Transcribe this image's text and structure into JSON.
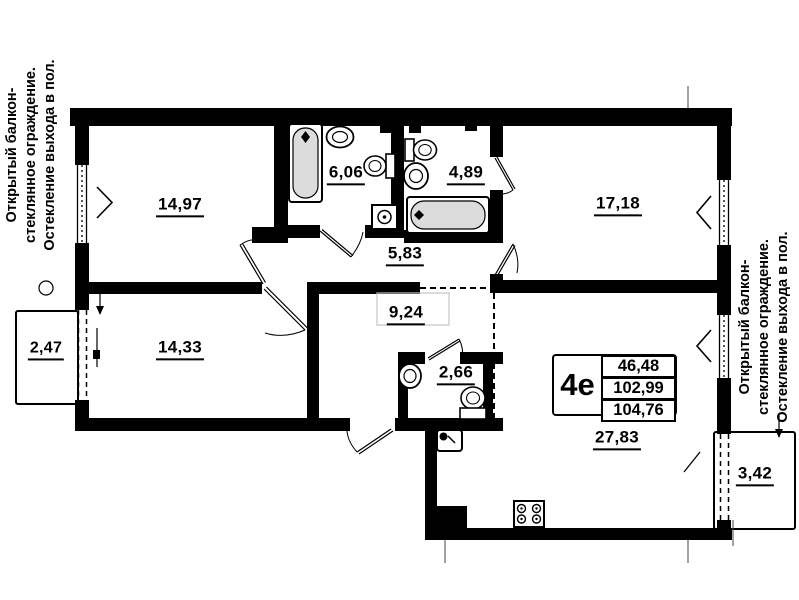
{
  "floor_plan": {
    "unit_box": {
      "type": "4е",
      "rows": [
        "46,48",
        "102,99",
        "104,76"
      ]
    },
    "rooms": {
      "bedroom_1": "14,97",
      "bathroom_1": "6,06",
      "bathroom_2": "4,89",
      "bedroom_2": "17,18",
      "corridor": "5,83",
      "hall": "9,24",
      "bedroom_3": "14,33",
      "balcony_left": "2,47",
      "wc": "2,66",
      "kitchen_living": "27,83",
      "balcony_right": "3,42"
    },
    "balcony_note": {
      "line1": "Открытый балкон-",
      "line2": "стеклянное ограждение.",
      "line3": "Остекление выхода в пол."
    },
    "icons": {
      "bathtub-icon": "rounded rectangle with drain diamond",
      "sink-icon": "double oval basin",
      "toilet-icon": "oval bowl with tank",
      "washing-machine-icon": "square with drum circle",
      "stove-icon": "square with four burners",
      "kitchen-sink-icon": "square basin with faucet dot",
      "vent-shaft-icon": "solid black square",
      "window-chevron-icon": "angle mark showing opening direction"
    },
    "colors": {
      "wall": "#000000",
      "tub_fill": "#dcdcdc",
      "background": "#ffffff"
    }
  }
}
